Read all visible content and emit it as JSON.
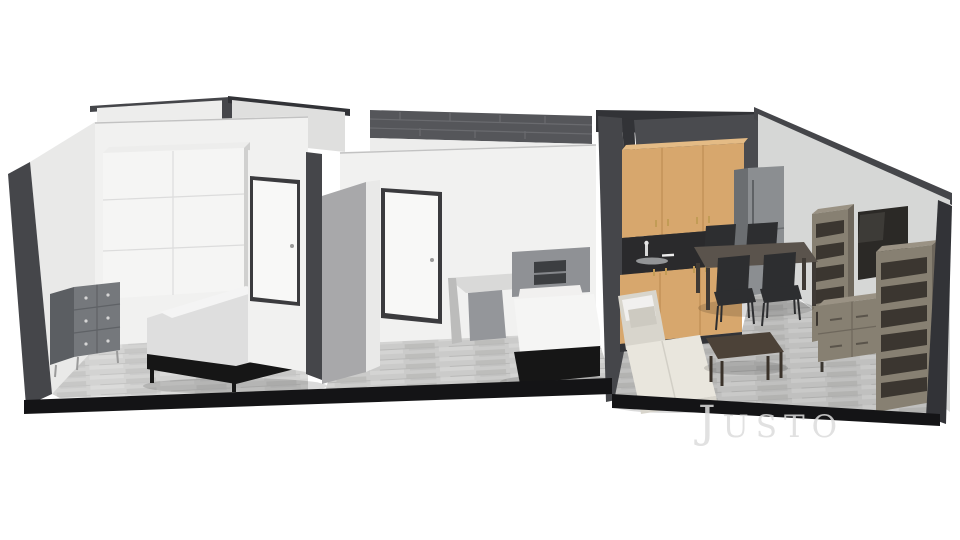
{
  "watermark": {
    "text": "Justo"
  },
  "colors": {
    "bg": "#ffffff",
    "wall_white": "#f1f1f0",
    "wall_white2": "#e9e9e8",
    "wall_light": "#ededec",
    "wall_mid": "#dfdfde",
    "wall_mid2": "#d6d7d6",
    "wall_shadow": "#d0d0cf",
    "edge_dark": "#45464a",
    "edge_dark2": "#323337",
    "edge_black": "#141416",
    "kitchen_wall": "#4a4b4f",
    "tile_dark": "#55565a",
    "tile_line": "#6a6b6f",
    "floor_base": "#cbcbca",
    "floor_streak": "#b9b9b8",
    "floor_light": "#d8d8d7",
    "cabinet": "#d7a76d",
    "cabinet_top": "#e4bb85",
    "cabinet_seam": "#b5854a",
    "counter": "#2a2a2c",
    "handle_gold": "#c29c56",
    "fridge": "#8b8e91",
    "fridge_side": "#6b6e71",
    "table_top": "#5a534c",
    "table_leg": "#3f3a35",
    "chair": "#2d2e30",
    "sofa": "#e9e6dd",
    "sofa_dark": "#d8d5cc",
    "sofa_pillow": "#cdcac1",
    "coffee": "#4c4238",
    "coffee_dark": "#3a322a",
    "tvunit": "#878072",
    "tvunit_top": "#9a9284",
    "tvunit_dark": "#6e675c",
    "tv_hole": "#3b3630",
    "tv_screen": "#2b2926",
    "bed_frame": "#161616",
    "duvet": "#dedede",
    "duvet_fold": "#f4f4f4",
    "sheet": "#f5f5f4",
    "pillow": "#f1f0ef",
    "headboard": "#8f9195",
    "niche": "#3c3e41",
    "dresser": "#75787c",
    "dresser_side": "#5b5e62",
    "knob": "#d5d5d5",
    "door": "#f8f8f7",
    "door_frame": "#3b3b3e",
    "pillar": "#a8a8aa",
    "desk": "#d9d9d8",
    "desk_side": "#bcbcbb",
    "cabinet_gray": "#94969a",
    "watermark": "#dcdcdc"
  }
}
